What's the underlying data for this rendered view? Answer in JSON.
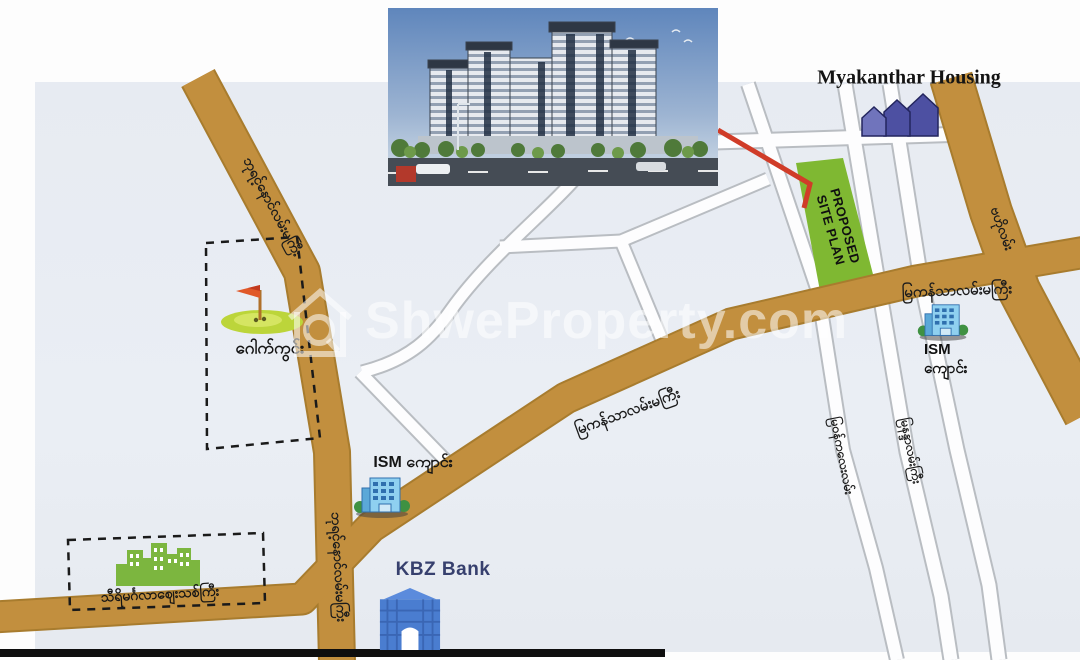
{
  "watermark": {
    "text": "ShweProperty.com",
    "icon": "house-magnifier-logo"
  },
  "site_plan": {
    "line1": "PROPOSED",
    "line2": "SITE PLAN",
    "fill_color": "#7fb832",
    "pointer_color": "#d03c28"
  },
  "landmarks": {
    "myakanthar_housing": {
      "label": "Myakanthar Housing",
      "icon": "blue-houses-icon"
    },
    "golf_course": {
      "label": "ဂေါက်ကွင်း",
      "icon": "golf-green-with-flag-icon"
    },
    "thiri_mingalar_market": {
      "label": "သီရိမင်္ဂလာဈေးသစ်ကြီး",
      "icon": "green-buildings-icon"
    },
    "ism_school_center": {
      "label": "ISM ကျောင်း",
      "icon": "school-building-icon"
    },
    "ism_school_east": {
      "label_line1": "ISM",
      "label_line2": "ကျောင်း",
      "icon": "school-building-icon"
    },
    "kbz_bank": {
      "label": "KBZ Bank",
      "icon": "bank-building-icon",
      "label_color": "#37406e"
    }
  },
  "road_labels": {
    "bayintnaung_road_upper": "ဘုရင့်နောင်လမ်းမကြီး",
    "bayintnaung_road_lower": "ဘုရင့်နောင်လမ်းမကြီး",
    "myakanthar_main_road_center": "မြကန်သာလမ်းမကြီး",
    "myakanthar_main_road_east": "မြကန်သာလမ်းမကြီး",
    "baho_road": "ဗဟိုလမ်း",
    "west_street": "မြဝန်ကလေးလမ်း",
    "east_street": "မြနန္ဒာလမ်းကြီး"
  },
  "colors": {
    "main_road": "#c28f3e",
    "road_casing": "#a87c2e",
    "map_background": "#e9edf3",
    "site_green": "#7fb832",
    "house_blue": "#4d50a2"
  }
}
